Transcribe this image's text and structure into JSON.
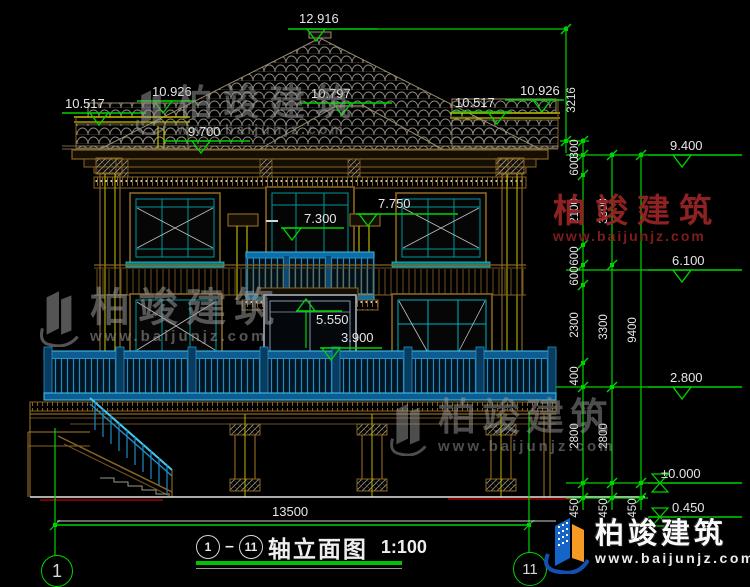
{
  "colors": {
    "dimension_green": "#00d400",
    "text_white": "#e6e6e6",
    "line_brown": "#8a6520",
    "railing_cyan": "#2196d4",
    "column_yellow": "#b8b400",
    "watermark_red": "#9b2424",
    "ground_red": "#7a0000",
    "brand_blue": "#1565c8",
    "brand_orange": "#f59a23"
  },
  "elevation_markers": [
    {
      "label": "12.916",
      "y": 29,
      "x1": 288,
      "x2": 378,
      "tri": 316,
      "lx": 299,
      "ly": 12,
      "type": "down"
    },
    {
      "label": "10.926",
      "y": 101,
      "x1": 137,
      "x2": 196,
      "tri": 163,
      "lx": 152,
      "ly": 85,
      "type": "down"
    },
    {
      "label": "10.517",
      "y": 113,
      "x1": 62,
      "x2": 146,
      "tri": 99,
      "lx": 65,
      "ly": 97,
      "type": "down"
    },
    {
      "label": "9.700",
      "y": 141,
      "x1": 163,
      "x2": 250,
      "tri": 201,
      "lx": 188,
      "ly": 125,
      "type": "down"
    },
    {
      "label": "10.797",
      "y": 103,
      "x1": 300,
      "x2": 392,
      "tri": 342,
      "lx": 311,
      "ly": 87,
      "type": "down"
    },
    {
      "label": "10.517",
      "y": 112,
      "x1": 452,
      "x2": 512,
      "tri": 497,
      "lx": 455,
      "ly": 96,
      "type": "down"
    },
    {
      "label": "10.926",
      "y": 100,
      "x1": 505,
      "x2": 564,
      "tri": 542,
      "lx": 520,
      "ly": 84,
      "type": "down"
    },
    {
      "label": "9.400",
      "y": 155,
      "x1": 648,
      "x2": 742,
      "tri": 682,
      "lx": 670,
      "ly": 139,
      "type": "down"
    },
    {
      "label": "7.750",
      "y": 214,
      "x1": 356,
      "x2": 458,
      "tri": 368,
      "lx": 378,
      "ly": 197,
      "type": "down"
    },
    {
      "label": "7.300",
      "y": 228,
      "x1": 281,
      "x2": 344,
      "tri": 292,
      "lx": 304,
      "ly": 212,
      "type": "down",
      "dash": true
    },
    {
      "label": "5.550",
      "y": 311,
      "x1": 296,
      "x2": 342,
      "tri": 306,
      "lx": 316,
      "ly": 313,
      "type": "up"
    },
    {
      "label": "3.900",
      "y": 348,
      "x1": 320,
      "x2": 382,
      "tri": 331,
      "lx": 341,
      "ly": 331,
      "type": "down"
    },
    {
      "label": "6.100",
      "y": 270,
      "x1": 648,
      "x2": 742,
      "tri": 682,
      "lx": 672,
      "ly": 254,
      "type": "down"
    },
    {
      "label": "2.800",
      "y": 387,
      "x1": 648,
      "x2": 742,
      "tri": 682,
      "lx": 670,
      "ly": 371,
      "type": "down"
    },
    {
      "label": "±0.000",
      "y": 483,
      "x1": 648,
      "x2": 742,
      "tri": 660,
      "lx": 661,
      "ly": 467,
      "type": "bowtie"
    },
    {
      "label": "0.450",
      "y": 517,
      "x1": 648,
      "x2": 742,
      "tri": 660,
      "lx": 672,
      "ly": 501,
      "type": "bowtie"
    }
  ],
  "dim_chains": {
    "chains": [
      {
        "x": 566,
        "side": "right",
        "ticks": [
          29,
          141
        ],
        "labels": [
          [
            "3216",
            100
          ]
        ]
      },
      {
        "x": 583,
        "side": "left",
        "ticks": [
          141,
          155,
          175,
          245,
          265,
          285,
          363,
          387,
          483,
          498
        ],
        "labels": [
          [
            "300",
            149
          ],
          [
            "600",
            166
          ],
          [
            "2100",
            211
          ],
          [
            "600",
            256
          ],
          [
            "600",
            276
          ],
          [
            "2300",
            325
          ],
          [
            "400",
            376
          ],
          [
            "2800",
            436
          ],
          [
            "450",
            508
          ]
        ]
      },
      {
        "x": 612,
        "side": "left",
        "ticks": [
          155,
          265,
          387,
          483,
          498
        ],
        "labels": [
          [
            "3300",
            211
          ],
          [
            "3300",
            327
          ],
          [
            "2800",
            436
          ],
          [
            "450",
            508
          ]
        ]
      },
      {
        "x": 641,
        "side": "left",
        "ticks": [
          155,
          483,
          498
        ],
        "labels": [
          [
            "9400",
            330
          ],
          [
            "450",
            508
          ]
        ]
      }
    ]
  },
  "bottom_dimension": {
    "value": "13500"
  },
  "axes": {
    "left": "1",
    "right": "11"
  },
  "drawing_title": {
    "axis_start": "1",
    "axis_end": "11",
    "name": "轴立面图",
    "scale": "1:100"
  },
  "watermarks": {
    "brand": "柏竣建筑",
    "url": "www.baijunjz.com"
  }
}
